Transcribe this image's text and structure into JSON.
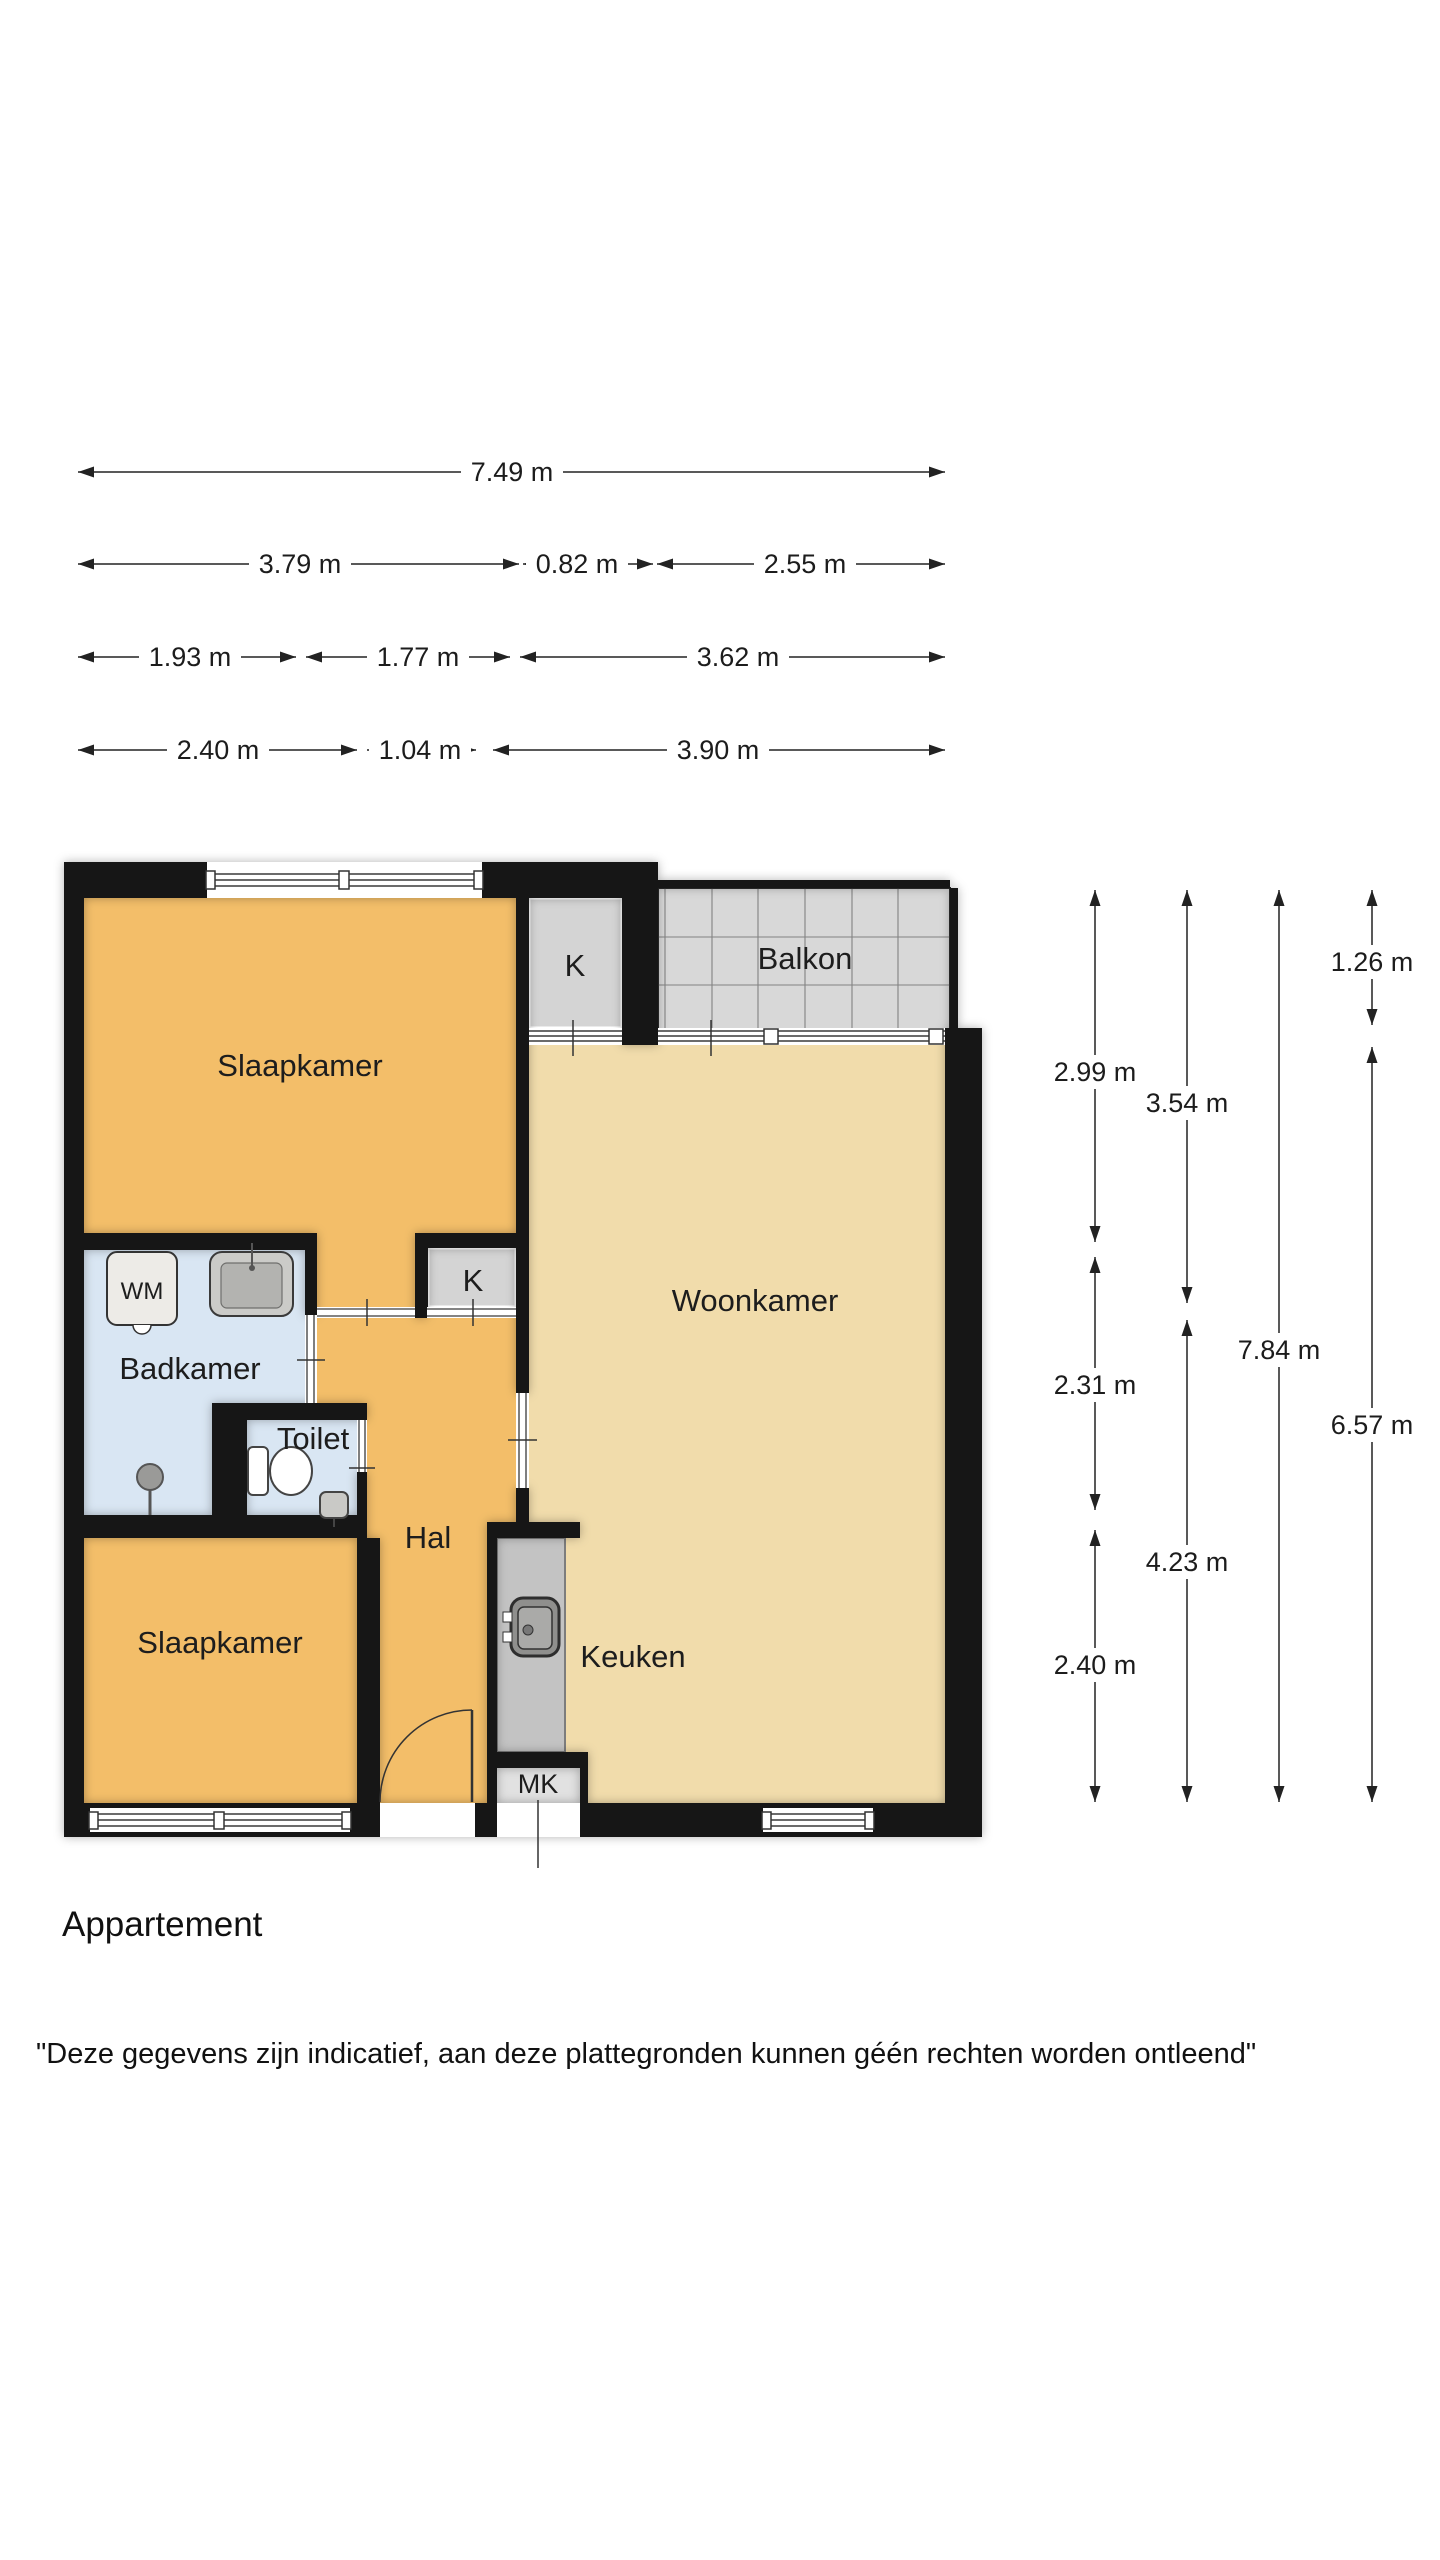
{
  "page": {
    "title": "Appartement",
    "disclaimer": "\"Deze gegevens zijn indicatief, aan deze plattegronden kunnen géén rechten worden ontleend\""
  },
  "floorplan": {
    "rooms": [
      {
        "id": "slaapkamer-1",
        "label": "Slaapkamer"
      },
      {
        "id": "closet-top",
        "label": "K"
      },
      {
        "id": "balkon",
        "label": "Balkon"
      },
      {
        "id": "woonkamer",
        "label": "Woonkamer"
      },
      {
        "id": "badkamer",
        "label": "Badkamer"
      },
      {
        "id": "closet-hal",
        "label": "K"
      },
      {
        "id": "toilet",
        "label": "Toilet"
      },
      {
        "id": "hal",
        "label": "Hal"
      },
      {
        "id": "slaapkamer-2",
        "label": "Slaapkamer"
      },
      {
        "id": "keuken",
        "label": "Keuken"
      },
      {
        "id": "meterkast",
        "label": "MK"
      },
      {
        "id": "wasmachine",
        "label": "WM"
      }
    ]
  },
  "dimensions": {
    "horizontal_rows": [
      {
        "y": 472,
        "segments": [
          {
            "x1": 78,
            "x2": 945,
            "label": "7.49 m",
            "lx": 512
          }
        ]
      },
      {
        "y": 564,
        "segments": [
          {
            "x1": 78,
            "x2": 519,
            "label": "3.79 m",
            "lx": 300
          },
          {
            "x1": 523,
            "x2": 653,
            "label": "0.82 m",
            "lx": 577
          },
          {
            "x1": 657,
            "x2": 945,
            "label": "2.55 m",
            "lx": 805
          }
        ]
      },
      {
        "y": 657,
        "segments": [
          {
            "x1": 78,
            "x2": 296,
            "label": "1.93 m",
            "lx": 190
          },
          {
            "x1": 306,
            "x2": 510,
            "label": "1.77 m",
            "lx": 418
          },
          {
            "x1": 520,
            "x2": 945,
            "label": "3.62 m",
            "lx": 738
          }
        ]
      },
      {
        "y": 750,
        "segments": [
          {
            "x1": 78,
            "x2": 357,
            "label": "2.40 m",
            "lx": 218
          },
          {
            "x1": 367,
            "x2": 476,
            "label": "1.04 m",
            "lx": 420
          },
          {
            "x1": 493,
            "x2": 945,
            "label": "3.90 m",
            "lx": 718
          }
        ]
      }
    ],
    "vertical_columns": [
      {
        "x": 1095,
        "segments": [
          {
            "y1": 890,
            "y2": 1242,
            "label": "2.99 m",
            "ly": 1072
          },
          {
            "y1": 1257,
            "y2": 1510,
            "label": "2.31 m",
            "ly": 1385
          },
          {
            "y1": 1530,
            "y2": 1802,
            "label": "2.40 m",
            "ly": 1665
          }
        ]
      },
      {
        "x": 1187,
        "segments": [
          {
            "y1": 890,
            "y2": 1303,
            "label": "3.54 m",
            "ly": 1103
          },
          {
            "y1": 1320,
            "y2": 1802,
            "label": "4.23 m",
            "ly": 1562
          }
        ]
      },
      {
        "x": 1279,
        "segments": [
          {
            "y1": 890,
            "y2": 1802,
            "label": "7.84 m",
            "ly": 1350
          }
        ]
      },
      {
        "x": 1372,
        "segments": [
          {
            "y1": 890,
            "y2": 1025,
            "label": "1.26 m",
            "ly": 962
          },
          {
            "y1": 1047,
            "y2": 1802,
            "label": "6.57 m",
            "ly": 1425
          }
        ]
      }
    ]
  },
  "colors": {
    "floor_orange": "#f3be69",
    "floor_beige": "#f1dcab",
    "floor_blue": "#d9e6f3",
    "closet_gray": "#d4d4d4",
    "balkon_gray": "#d8d8d8",
    "counter_gray": "#c3c3c3",
    "mk_gray": "#e1e1e1",
    "wall_black": "#161616",
    "dim_color": "#222222"
  }
}
